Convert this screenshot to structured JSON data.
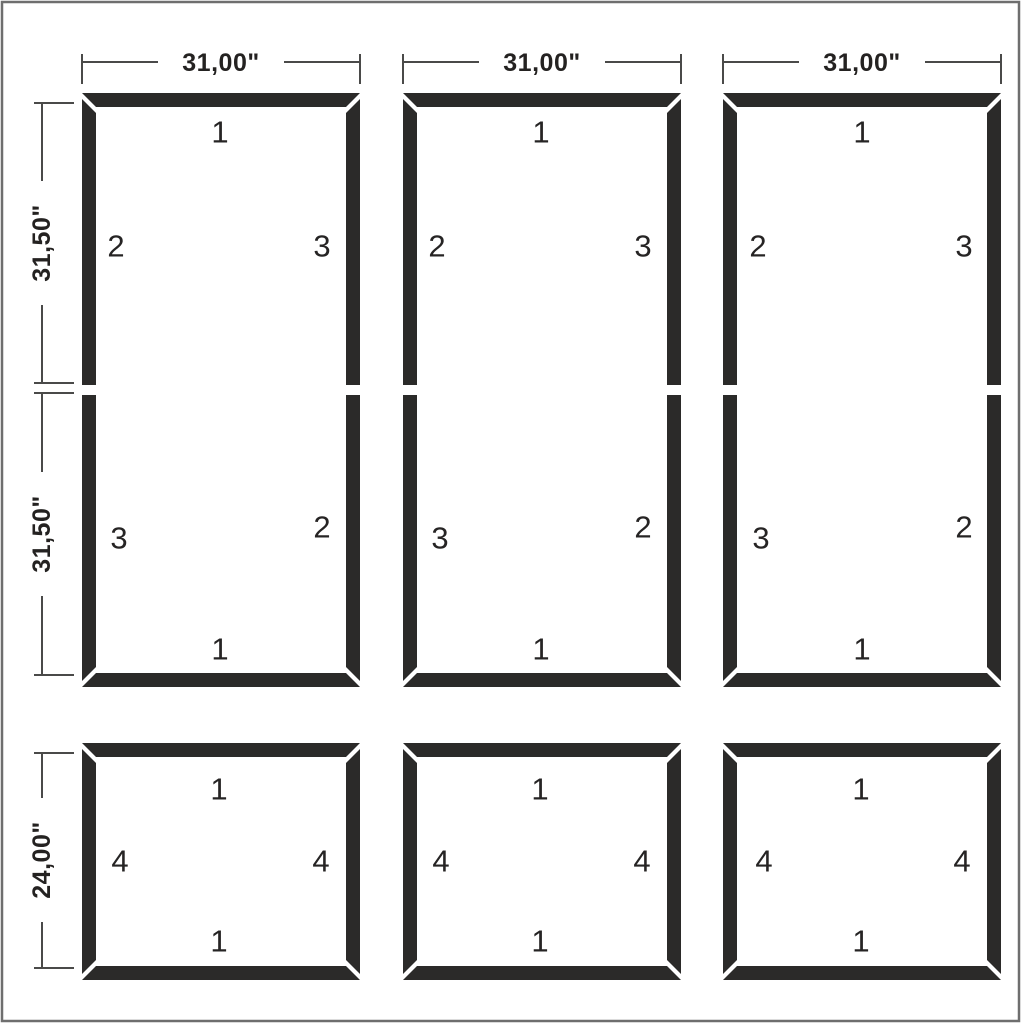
{
  "width_dims": [
    "31,00\"",
    "31,00\"",
    "31,00\""
  ],
  "height_dims": {
    "upper": "31,50\"",
    "lower": "31,50\"",
    "short": "24,00\""
  },
  "tall_frames": [
    {
      "upper_top": "1",
      "upper_left": "2",
      "upper_right": "3",
      "lower_left": "3",
      "lower_right": "2",
      "lower_bottom": "1"
    },
    {
      "upper_top": "1",
      "upper_left": "2",
      "upper_right": "3",
      "lower_left": "3",
      "lower_right": "2",
      "lower_bottom": "1"
    },
    {
      "upper_top": "1",
      "upper_left": "2",
      "upper_right": "3",
      "lower_left": "3",
      "lower_right": "2",
      "lower_bottom": "1"
    }
  ],
  "short_frames": [
    {
      "top": "1",
      "left": "4",
      "right": "4",
      "bottom": "1"
    },
    {
      "top": "1",
      "left": "4",
      "right": "4",
      "bottom": "1"
    },
    {
      "top": "1",
      "left": "4",
      "right": "4",
      "bottom": "1"
    }
  ],
  "colors": {
    "molding": "#2b2a29",
    "dimension_line": "#4a4a49",
    "text": "#262424",
    "page_border": "#6e6e6e",
    "background": "#ffffff"
  }
}
